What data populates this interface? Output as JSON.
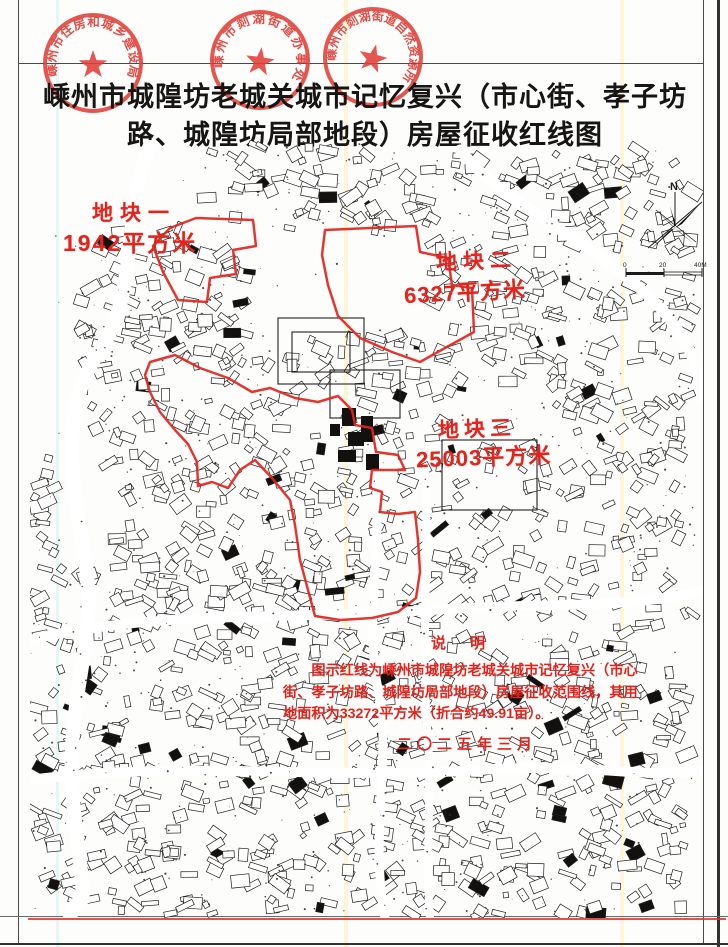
{
  "title": {
    "line1": "嵊州市城隍坊老城关城市记忆复兴（市心街、孝子坊",
    "line2": "路、城隍坊局部地段）房屋征收红线图"
  },
  "seals": [
    {
      "text": "嵊州市住房和城乡建设局"
    },
    {
      "text": "嵊州市剡湖街道办事处"
    },
    {
      "text": "嵊州市剡湖街道自然资源所"
    }
  ],
  "parcels": [
    {
      "name": "地块一",
      "area": "1942平方米"
    },
    {
      "name": "地块二",
      "area": "6327平方米"
    },
    {
      "name": "地块三",
      "area": "25003平方米"
    }
  ],
  "note": {
    "heading": "说  明",
    "line1": "图示红线为嵊州市城隍坊老城关城市记忆复兴（市心",
    "line2": "街、孝子坊路、城隍坊局部地段）房屋征收范围线，其用",
    "line3": "地面积为33272平方米（折合约49.91亩）。",
    "date": "二〇二五年三月"
  },
  "compass": {
    "north_label": "N"
  },
  "scalebar": {
    "labels": [
      "0",
      "20",
      "40M"
    ]
  },
  "colors": {
    "seal_red": "#e2403a",
    "redline": "#e02620",
    "ink": "#23211f"
  }
}
